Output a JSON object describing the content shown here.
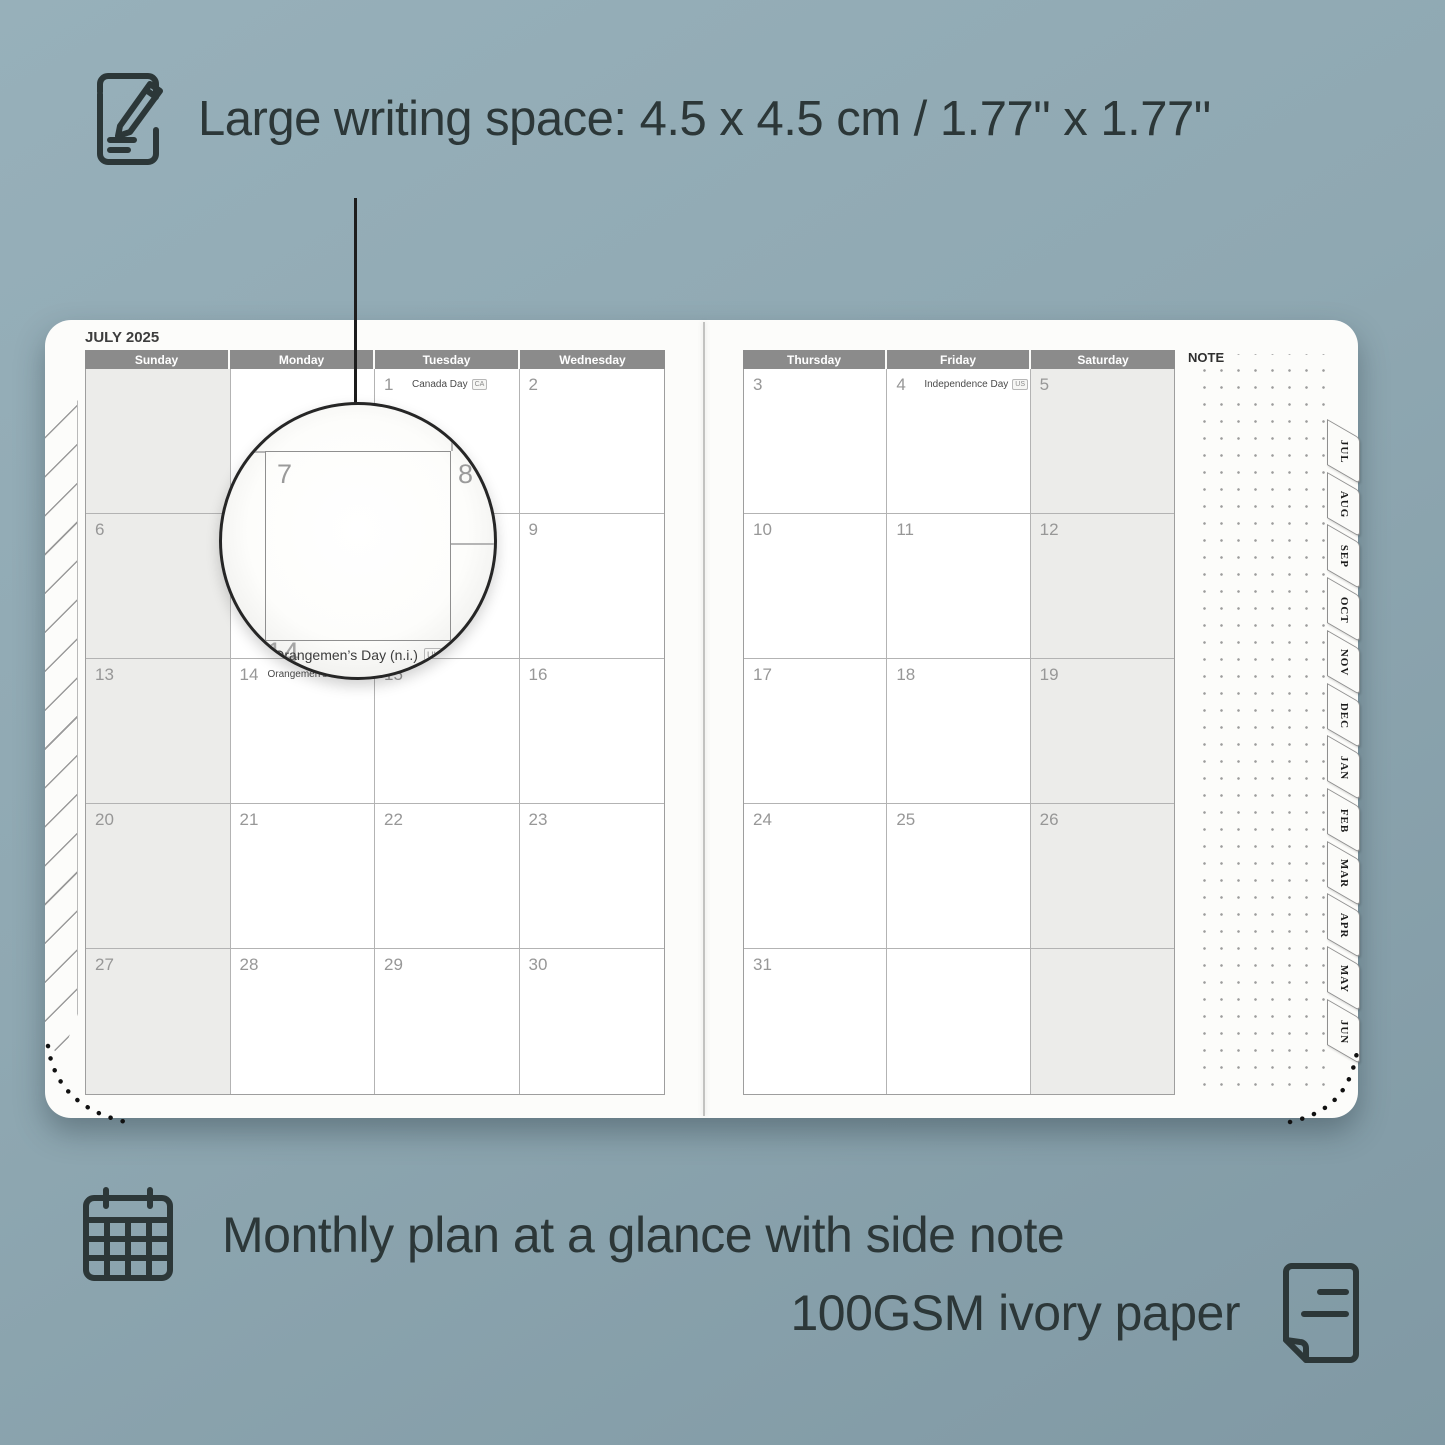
{
  "top_banner": {
    "text": "Large writing space: 4.5 x 4.5 cm / 1.77\" x 1.77\""
  },
  "calendar": {
    "month_title": "JULY 2025",
    "note_label": "NOTE",
    "left_page": {
      "weekdays": [
        "Sunday",
        "Monday",
        "Tuesday",
        "Wednesday"
      ],
      "shaded_column": 0,
      "rows": [
        [
          {
            "day": ""
          },
          {
            "day": ""
          },
          {
            "day": "1",
            "holiday": "Canada Day",
            "badge": "CA"
          },
          {
            "day": "2"
          }
        ],
        [
          {
            "day": "6"
          },
          {
            "day": "7"
          },
          {
            "day": "8"
          },
          {
            "day": "9"
          }
        ],
        [
          {
            "day": "13"
          },
          {
            "day": "14",
            "holiday": "Orangemen’s Day (n.i.)",
            "badge": "UK"
          },
          {
            "day": "15"
          },
          {
            "day": "16"
          }
        ],
        [
          {
            "day": "20"
          },
          {
            "day": "21"
          },
          {
            "day": "22"
          },
          {
            "day": "23"
          }
        ],
        [
          {
            "day": "27"
          },
          {
            "day": "28"
          },
          {
            "day": "29"
          },
          {
            "day": "30"
          }
        ]
      ]
    },
    "right_page": {
      "weekdays": [
        "Thursday",
        "Friday",
        "Saturday"
      ],
      "shaded_column": 2,
      "rows": [
        [
          {
            "day": "3"
          },
          {
            "day": "4",
            "holiday": "Independence Day",
            "badge": "US"
          },
          {
            "day": "5"
          }
        ],
        [
          {
            "day": "10"
          },
          {
            "day": "11"
          },
          {
            "day": "12"
          }
        ],
        [
          {
            "day": "17"
          },
          {
            "day": "18"
          },
          {
            "day": "19"
          }
        ],
        [
          {
            "day": "24"
          },
          {
            "day": "25"
          },
          {
            "day": "26"
          }
        ],
        [
          {
            "day": "31"
          },
          {
            "day": ""
          },
          {
            "day": ""
          }
        ]
      ]
    },
    "tabs": [
      "JUL",
      "AUG",
      "SEP",
      "OCT",
      "NOV",
      "DEC",
      "JAN",
      "FEB",
      "MAR",
      "APR",
      "MAY",
      "JUN"
    ]
  },
  "magnifier": {
    "day_left": "7",
    "day_right": "8",
    "ghost_day": "14",
    "holiday": "Orangemen’s Day (n.i.)",
    "badge": "UK"
  },
  "bottom_banner": {
    "line1": "Monthly plan at a glance with side note",
    "line2": "100GSM ivory paper"
  },
  "colors": {
    "background": "#8fa8b2",
    "ink": "#2c3738",
    "page": "#fcfcfa",
    "header_gray": "#8b8b8b",
    "weekend_shade": "#ececea",
    "day_number": "#979797",
    "grid_line": "#b3b3b3"
  }
}
